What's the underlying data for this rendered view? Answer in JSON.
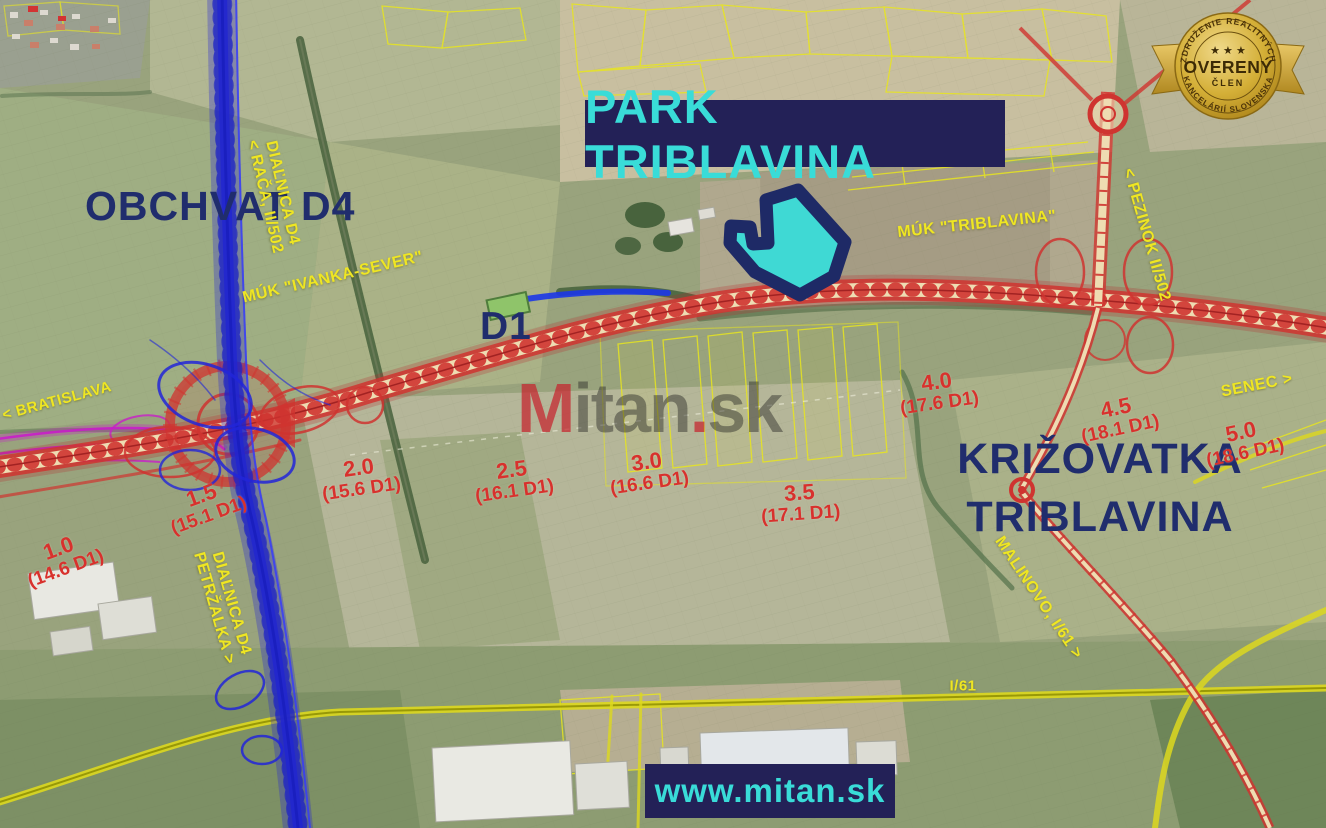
{
  "title_banner": {
    "text": "PARK TRIBLAVINA"
  },
  "site_banner": {
    "text": "www.mitan.sk"
  },
  "watermark": {
    "m": "M",
    "itan": "itan",
    "dot": ".",
    "sk": "sk"
  },
  "badge": {
    "top_arc": "ZDRUŽENIE REALITNÝCH",
    "stars": "★ ★ ★",
    "center": "OVERENÝ",
    "sub": "ČLEN",
    "bottom_arc": "KANCELÁRIÍ SLOVENSKA"
  },
  "headings": {
    "obchvat_d4": "OBCHVAT D4",
    "d1": "D1",
    "krizovatka_line1": "KRIŽOVATKA",
    "krizovatka_line2": "TRIBLAVINA"
  },
  "road_labels": {
    "dialnica_raca_line1": "DIAĽNICA D4",
    "dialnica_raca_line2": "< RAČA, II/502",
    "muk_ivanka": "MÚK \"IVANKA-SEVER\"",
    "muk_triblavina": "MÚK \"TRIBLAVINA\"",
    "pezinok": "< PEZINOK II/502",
    "senec": "SENEC >",
    "bratislava": "< BRATISLAVA",
    "malinovo": "MALINOVO, I/61 >",
    "dialnica_petrzalka_line1": "DIAĽNICA D4",
    "dialnica_petrzalka_line2": "PETRŽALKA >",
    "i61": "I/61"
  },
  "distance_markers": [
    {
      "km": "1.0",
      "ref": "(14.6 D1)"
    },
    {
      "km": "1.5",
      "ref": "(15.1 D1)"
    },
    {
      "km": "2.0",
      "ref": "(15.6 D1)"
    },
    {
      "km": "2.5",
      "ref": "(16.1 D1)"
    },
    {
      "km": "3.0",
      "ref": "(16.6 D1)"
    },
    {
      "km": "3.5",
      "ref": "(17.1 D1)"
    },
    {
      "km": "4.0",
      "ref": "(17.6 D1)"
    },
    {
      "km": "4.5",
      "ref": "(18.1 D1)"
    },
    {
      "km": "5.0",
      "ref": "(18.6 D1)"
    }
  ],
  "colors": {
    "banner_bg": "#232157",
    "banner_text": "#39dcd8",
    "navy_text": "#202d6d",
    "yellow_label": "#efe622",
    "red_marker": "#d8312d",
    "d1_red": "#cf3430",
    "d4_blue": "#2428e0",
    "cadastral_yellow": "#e8e51f",
    "park_fill": "#3fd9d4",
    "park_outline": "#1e2a66",
    "badge_gold": "#d4af37"
  }
}
